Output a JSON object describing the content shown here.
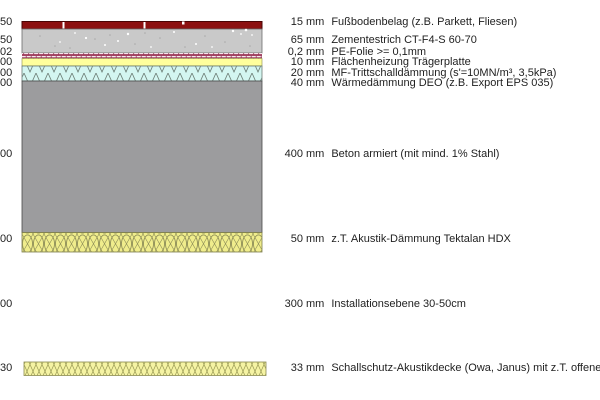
{
  "diagram": {
    "title_hint": "floor construction cross-section",
    "layers": [
      {
        "dim_fragment": "50",
        "thickness": "15",
        "unit": "mm",
        "label": "Fußbodenbelag (z.B. Parkett, Fliesen)"
      },
      {
        "dim_fragment": "50",
        "thickness": "65",
        "unit": "mm",
        "label": "Zementestrich CT-F4-S 60-70"
      },
      {
        "dim_fragment": "02",
        "thickness": "0,2",
        "unit": "mm",
        "label": "PE-Folie >= 0,1mm"
      },
      {
        "dim_fragment": "00",
        "thickness": "10",
        "unit": "mm",
        "label": "Flächenheizung Trägerplatte"
      },
      {
        "dim_fragment": "00",
        "thickness": "20",
        "unit": "mm",
        "label": "MF-Trittschalldämmung (s'=10MN/m³, 3,5kPa)"
      },
      {
        "dim_fragment": "00",
        "thickness": "40",
        "unit": "mm",
        "label": "Wärmedämmung DEO (z.B. Export EPS 035)"
      },
      {
        "dim_fragment": "00",
        "thickness": "400",
        "unit": "mm",
        "label": "Beton armiert (mit mind. 1% Stahl)"
      },
      {
        "dim_fragment": "00",
        "thickness": "50",
        "unit": "mm",
        "label": "z.T. Akustik-Dämmung Tektalan HDX"
      },
      {
        "dim_fragment": "00",
        "thickness": "300",
        "unit": "mm",
        "label": "Installationsebene 30-50cm"
      },
      {
        "dim_fragment": "30",
        "thickness": "33",
        "unit": "mm",
        "label": "Schallschutz-Akustikdecke (Owa, Janus) mit z.T. offenen Fugen"
      }
    ],
    "colors": {
      "flooring": "#8C1111",
      "screed": "#C9C9C9",
      "foil_band_bg": "#F6E8EE",
      "foil_hatch_line": "#993355",
      "impact_insulation": "#FFFF9C",
      "rigid_insulation_bg": "#D4F6F1",
      "concrete": "#9C9C9E",
      "woodwool_bg": "#F0ED8C",
      "ceiling_bg": "#F5F3A3",
      "text": "#1f1f1f"
    }
  }
}
